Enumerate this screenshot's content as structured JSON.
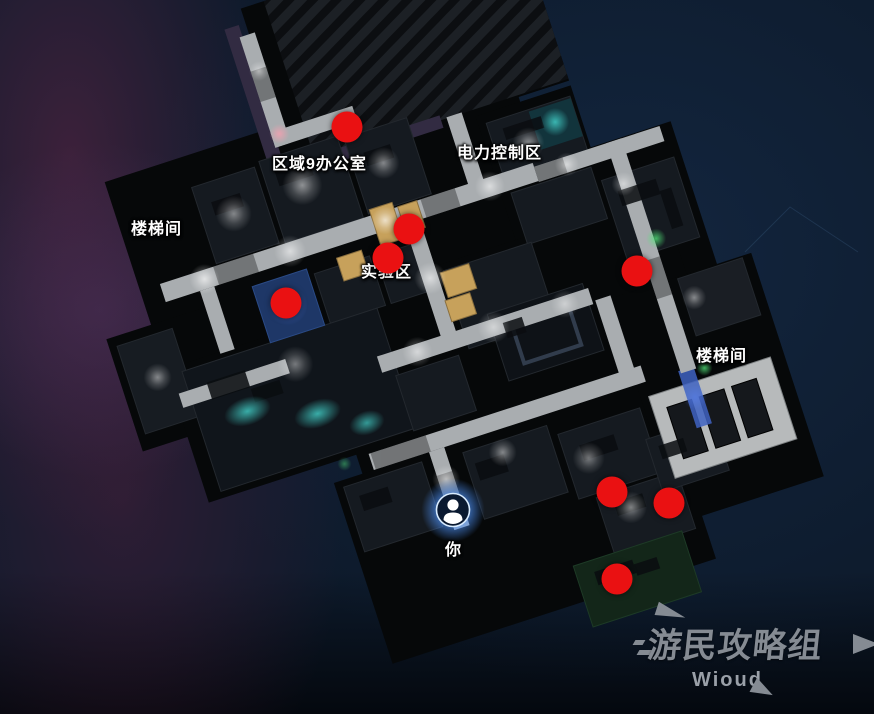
{
  "scene": {
    "kind": "game-map-screenshot",
    "background_color": "#0d1a2b",
    "accent_red": "#ea1112",
    "player_glow_color": "#4da3ff"
  },
  "map": {
    "area_labels": [
      {
        "id": "area9-office",
        "text": "区域9办公室",
        "x": 272,
        "y": 150
      },
      {
        "id": "power-control",
        "text": "电力控制区",
        "x": 457,
        "y": 139
      },
      {
        "id": "stairwell-left",
        "text": "楼梯间",
        "x": 131,
        "y": 215
      },
      {
        "id": "lab-area",
        "text": "实验区",
        "x": 361,
        "y": 258
      },
      {
        "id": "stairwell-right",
        "text": "楼梯间",
        "x": 696,
        "y": 342
      }
    ],
    "objective_markers": {
      "color": "#ea1112",
      "diameter": 31,
      "points": [
        {
          "x": 347,
          "y": 127
        },
        {
          "x": 409,
          "y": 229
        },
        {
          "x": 388,
          "y": 258
        },
        {
          "x": 286,
          "y": 303
        },
        {
          "x": 637,
          "y": 271
        },
        {
          "x": 612,
          "y": 492
        },
        {
          "x": 669,
          "y": 503
        },
        {
          "x": 617,
          "y": 579
        }
      ]
    },
    "player": {
      "label": "你",
      "x": 453,
      "y": 510
    }
  },
  "watermark": {
    "title": "游民攻略组",
    "subtitle": "Wioud",
    "color": "#858b93"
  }
}
